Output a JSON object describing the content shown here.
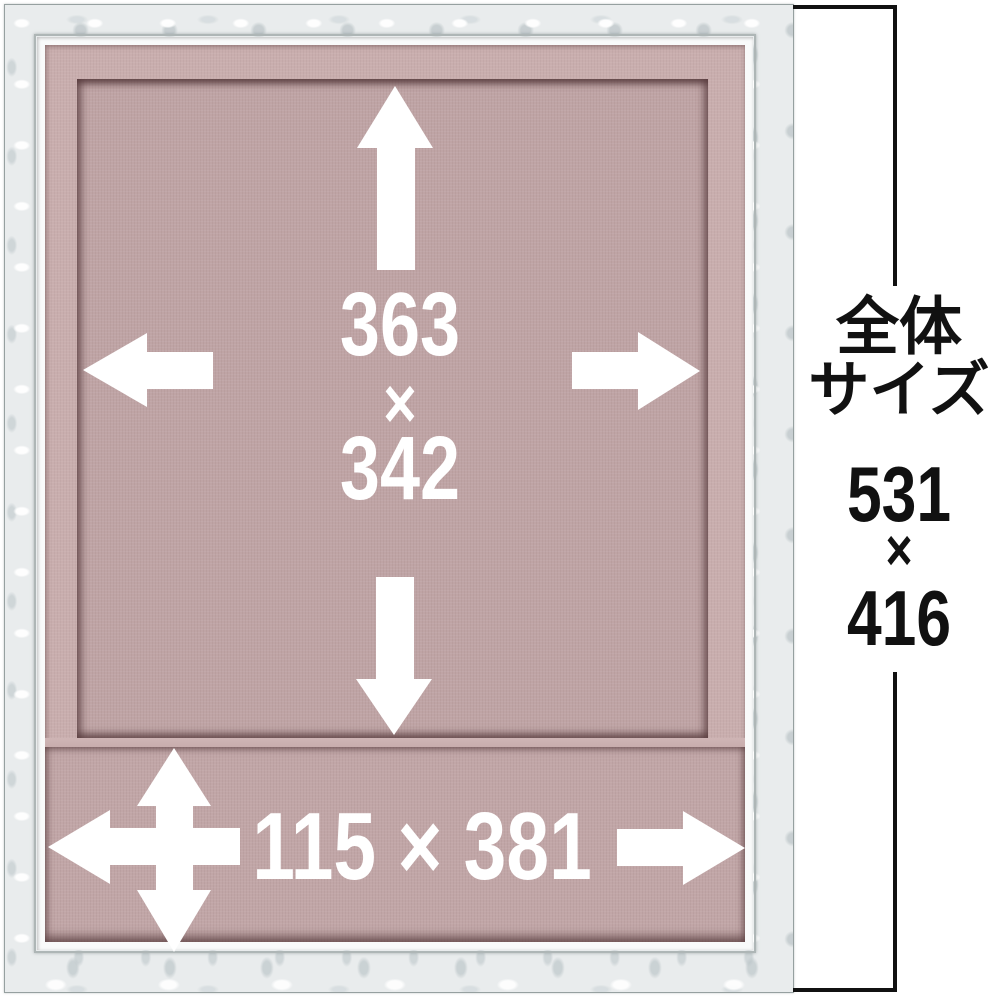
{
  "annotations": {
    "window_size": {
      "height": "363",
      "sep": "×",
      "width": "342"
    },
    "bottom_size": "115 × 381",
    "overall": {
      "title_line1": "全体",
      "title_line2": "サイズ",
      "height": "531",
      "sep": "×",
      "width": "416"
    }
  },
  "colors": {
    "frame_silver": "#e9eced",
    "frame_edge": "#96a0a0",
    "frame_lip": "#f9fafa",
    "mat_margin_pink": "#c9aeae",
    "mat_window_pink": "#bfa4a5",
    "mat_bottom_pink": "#c1a6a7",
    "annotation_white": "#ffffff",
    "annotation_black": "#111111"
  }
}
